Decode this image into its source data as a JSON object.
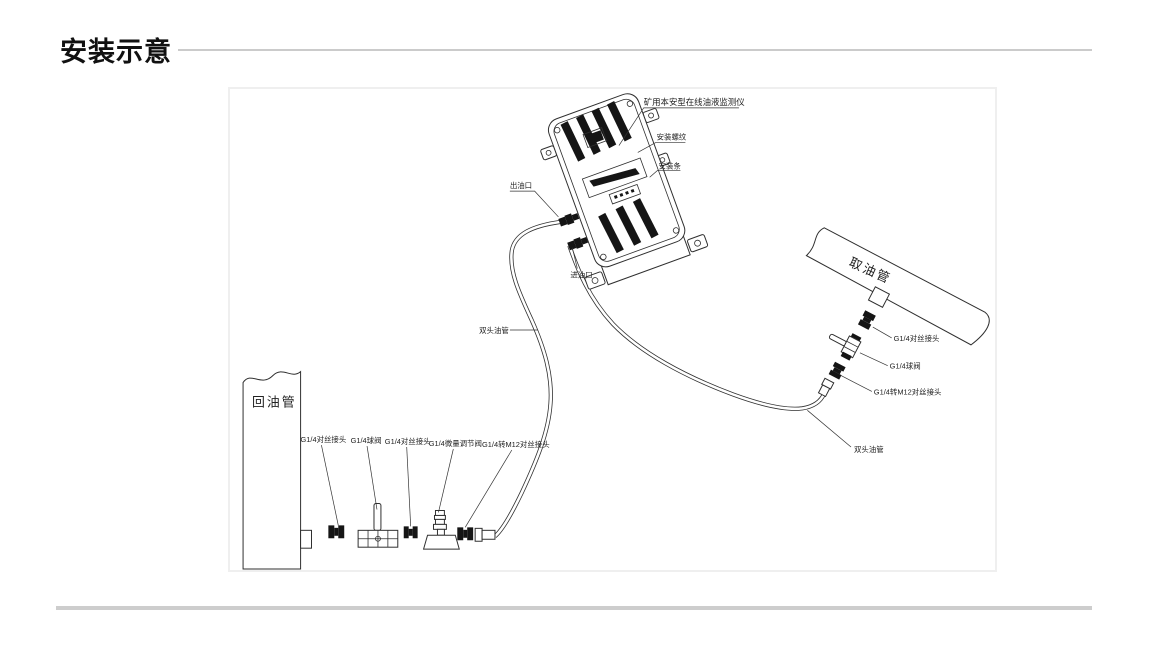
{
  "header": {
    "title": "安装示意"
  },
  "diagram": {
    "device": "矿用本安型在线油液监测仪",
    "mount_thread": "安装螺纹",
    "mount_bar": "安装条",
    "oil_outlet": "出油口",
    "oil_inlet": "进油口",
    "double_head_hose_left": "双头油管",
    "double_head_hose_right": "双头油管",
    "return_pipe": "回油管",
    "intake_pipe": "取油管",
    "bottom_fittings": [
      "G1/4对丝接头",
      "G1/4球阀",
      "G1/4对丝接头",
      "G1/4微量调节阀",
      "G1/4转M12对丝接头"
    ],
    "right_fittings": [
      "G1/4对丝接头",
      "G1/4球阀",
      "G1/4转M12对丝接头"
    ]
  }
}
